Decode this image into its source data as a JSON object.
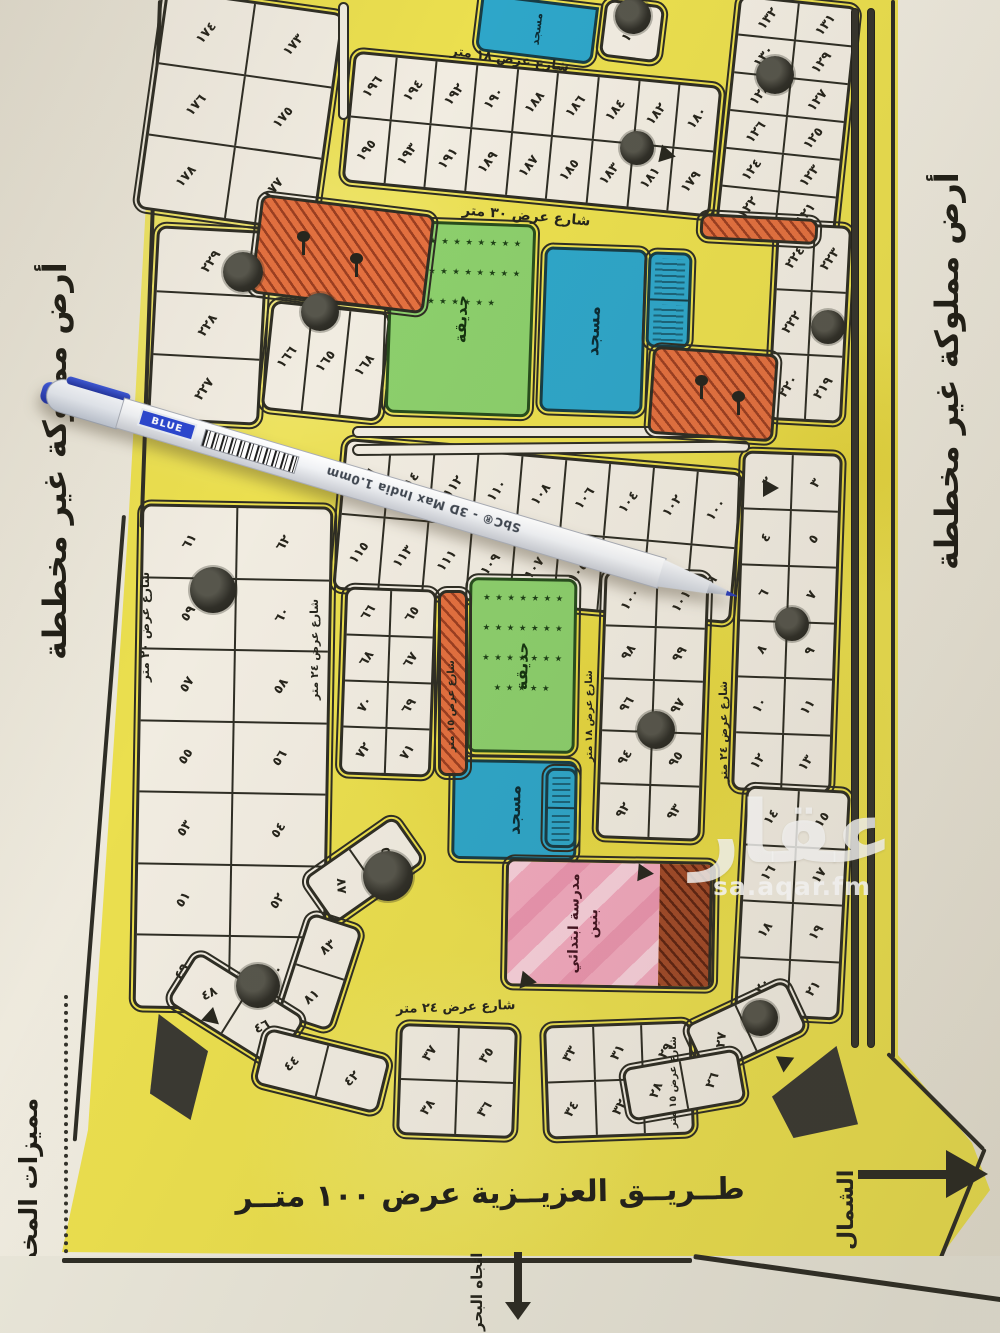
{
  "side_labels": {
    "left": "أرض مملوكة غير مخططة",
    "right": "أرض مملوكة غير مخططة",
    "bottom_left": "مميزات المخطط"
  },
  "compass": {
    "north_label": "الشمال",
    "sea_label": "اتجاه البحر"
  },
  "main_road": {
    "label": "طــريــق العزيــزية عرض ١٠٠ متــر"
  },
  "features": {
    "park_label": "حديقة",
    "mosque_label": "مسجد",
    "school_label": "مدرسة ابتدائي بنين",
    "park_star": "٭"
  },
  "watermark": {
    "logo": "عقار",
    "site": "sa.aqar.fm"
  },
  "pen": {
    "color_label": "BLUE",
    "brand": "SbC® - 3D Max India 1.0mm"
  },
  "colors": {
    "road_yellow": "#ebdf4e",
    "plot_fill": "#f1ece1",
    "ink": "#2e2d24",
    "mosque_blue": "#2ea6c9",
    "park_green": "#8ccf6c",
    "commercial_orange": "#e3703f",
    "school_pink": "#f2a9be",
    "paper": "#e9e4d7"
  },
  "street_labels": [
    {
      "text": "شارع عرض ١٨ متر",
      "x": 450,
      "y": 52,
      "rot": 8,
      "v": false,
      "s": 13
    },
    {
      "text": "شارع عرض ٣٠ متر",
      "x": 462,
      "y": 208,
      "rot": 5,
      "v": false,
      "s": 14
    },
    {
      "text": "شارع عرض ٢٤ متر",
      "x": 396,
      "y": 1000,
      "rot": -2,
      "v": false,
      "s": 13
    },
    {
      "text": "شارع عرض ٢٠ متر",
      "x": 138,
      "y": 682,
      "rot": 0,
      "v": true,
      "s": 12
    },
    {
      "text": "شارع عرض ٢٤ متر",
      "x": 308,
      "y": 700,
      "rot": 0,
      "v": true,
      "s": 11
    },
    {
      "text": "شارع عرض ١٥ متر",
      "x": 446,
      "y": 752,
      "rot": 0,
      "v": true,
      "s": 10
    },
    {
      "text": "شارع عرض ١٨ متر",
      "x": 584,
      "y": 762,
      "rot": 0,
      "v": true,
      "s": 10
    },
    {
      "text": "شارع عرض ٢٤ متر",
      "x": 717,
      "y": 782,
      "rot": 0,
      "v": true,
      "s": 11
    },
    {
      "text": "شارع عرض ١٥ متر",
      "x": 668,
      "y": 1128,
      "rot": 0,
      "v": true,
      "s": 10
    }
  ],
  "blocks": [
    {
      "id": "top-left",
      "x": 150,
      "y": 0,
      "w": 180,
      "h": 222,
      "rot": 8,
      "rows": [
        [
          "١٧٤",
          "١٧٣"
        ],
        [
          "١٧٦",
          "١٧٥"
        ],
        [
          "١٧٨",
          "١٧٧"
        ]
      ]
    },
    {
      "id": "top-row",
      "x": 347,
      "y": 68,
      "w": 370,
      "h": 132,
      "rot": 5.5,
      "rows": [
        [
          "١٩٦",
          "١٩٤",
          "١٩٢",
          "١٩٠",
          "١٨٨",
          "١٨٦",
          "١٨٤",
          "١٨٢",
          "١٨٠"
        ],
        [
          "١٩٥",
          "١٩٣",
          "١٩١",
          "١٨٩",
          "١٨٧",
          "١٨٥",
          "١٨٣",
          "١٨١",
          "١٧٩"
        ]
      ]
    },
    {
      "id": "mosque-corner-cell",
      "x": 602,
      "y": 2,
      "w": 60,
      "h": 58,
      "rot": 7,
      "rows": [
        [
          "١٩٧"
        ]
      ]
    },
    {
      "id": "top-right",
      "x": 727,
      "y": 0,
      "w": 120,
      "h": 232,
      "rot": 6,
      "rows": [
        [
          "١٣٢",
          "١٣١"
        ],
        [
          "١٣٠",
          "١٢٩"
        ],
        [
          "١٢٨",
          "١٢٧"
        ],
        [
          "١٢٦",
          "١٢٥"
        ],
        [
          "١٢٤",
          "١٢٣"
        ],
        [
          "١٢٢",
          "١٢١"
        ]
      ]
    },
    {
      "id": "band2-left-col",
      "x": 152,
      "y": 228,
      "w": 112,
      "h": 195,
      "rot": 3,
      "rows": [
        [
          "٢٢٩"
        ],
        [
          "٢٢٨"
        ],
        [
          "٢٢٧"
        ]
      ]
    },
    {
      "id": "band2-small-row",
      "x": 266,
      "y": 306,
      "w": 120,
      "h": 110,
      "rot": 6,
      "rows": [
        [
          "١٦٦",
          "١٦٥",
          "١٦٨"
        ]
      ]
    },
    {
      "id": "band2-right",
      "x": 772,
      "y": 224,
      "w": 75,
      "h": 198,
      "rot": 3,
      "rows": [
        [
          "٢٢٤",
          "٢٢٣"
        ],
        [
          "٢٢٢",
          "٢٢١"
        ],
        [
          "٢٢٠",
          "٢١٩"
        ]
      ]
    },
    {
      "id": "mid-row",
      "x": 338,
      "y": 455,
      "w": 400,
      "h": 152,
      "rot": 5,
      "rows": [
        [
          "١١٦",
          "١١٤",
          "١١٢",
          "١١٠",
          "١٠٨",
          "١٠٦",
          "١٠٤",
          "١٠٢",
          "١٠٠"
        ],
        [
          "١١٥",
          "١١٣",
          "١١١",
          "١٠٩",
          "١٠٧",
          "١٠٥",
          "١٠٣",
          "١٠١",
          "٩٩"
        ]
      ]
    },
    {
      "id": "right-tall",
      "x": 737,
      "y": 452,
      "w": 100,
      "h": 340,
      "rot": 2,
      "rows": [
        [
          "٢",
          "٣"
        ],
        [
          "٤",
          "٥"
        ],
        [
          "٦",
          "٧"
        ],
        [
          "٨",
          "٩"
        ],
        [
          "١٠",
          "١١"
        ],
        [
          "١٢",
          "١٣"
        ]
      ]
    },
    {
      "id": "left-tall",
      "x": 137,
      "y": 505,
      "w": 192,
      "h": 505,
      "rot": 1,
      "rows": [
        [
          "٦١",
          "٦٢"
        ],
        [
          "٥٩",
          "٦٠"
        ],
        [
          "٥٧",
          "٥٨"
        ],
        [
          "٥٥",
          "٥٦"
        ],
        [
          "٥٣",
          "٥٤"
        ],
        [
          "٥١",
          "٥٢"
        ],
        [
          "٤٩",
          "٥٠"
        ]
      ]
    },
    {
      "id": "inner-small",
      "x": 342,
      "y": 588,
      "w": 92,
      "h": 188,
      "rot": 2,
      "rows": [
        [
          "٦٦",
          "٦٥"
        ],
        [
          "٦٨",
          "٦٧"
        ],
        [
          "٧٠",
          "٦٩"
        ],
        [
          "٧٢",
          "٧١"
        ]
      ]
    },
    {
      "id": "park-right",
      "x": 600,
      "y": 572,
      "w": 105,
      "h": 268,
      "rot": 2,
      "rows": [
        [
          "١٠٠",
          "١٠١"
        ],
        [
          "٩٨",
          "٩٩"
        ],
        [
          "٩٦",
          "٩٧"
        ],
        [
          "٩٤",
          "٩٥"
        ],
        [
          "٩٢",
          "٩٣"
        ]
      ]
    },
    {
      "id": "school-right",
      "x": 740,
      "y": 788,
      "w": 105,
      "h": 230,
      "rot": 3,
      "rows": [
        [
          "١٤",
          "١٥"
        ],
        [
          "١٦",
          "١٧"
        ],
        [
          "١٨",
          "١٩"
        ],
        [
          "٢٠",
          "٢١"
        ]
      ]
    },
    {
      "id": "fan-left-a",
      "x": 308,
      "y": 842,
      "w": 112,
      "h": 56,
      "rot": -35,
      "rows": [
        [
          "٨٧",
          "٨٥"
        ]
      ]
    },
    {
      "id": "fan-left-b",
      "x": 292,
      "y": 918,
      "w": 56,
      "h": 108,
      "rot": 18,
      "rows": [
        [
          "٨٣"
        ],
        [
          "٨١"
        ]
      ]
    },
    {
      "id": "curve-left-a",
      "x": 172,
      "y": 980,
      "w": 128,
      "h": 60,
      "rot": 32,
      "rows": [
        [
          "٤٨",
          "٤٦"
        ]
      ]
    },
    {
      "id": "curve-left-b",
      "x": 258,
      "y": 1042,
      "w": 128,
      "h": 58,
      "rot": 14,
      "rows": [
        [
          "٤٤",
          "٤٢"
        ]
      ]
    },
    {
      "id": "bottom-inner-left",
      "x": 398,
      "y": 1025,
      "w": 118,
      "h": 112,
      "rot": 2,
      "rows": [
        [
          "٣٧",
          "٣٥"
        ],
        [
          "٣٨",
          "٣٦"
        ]
      ]
    },
    {
      "id": "bottom-inner-mid",
      "x": 545,
      "y": 1023,
      "w": 148,
      "h": 114,
      "rot": -2,
      "rows": [
        [
          "٣٣",
          "٣١",
          "٢٩"
        ],
        [
          "٣٤",
          "٣٢",
          "٣٠"
        ]
      ]
    },
    {
      "id": "curve-right-a",
      "x": 690,
      "y": 1000,
      "w": 112,
      "h": 56,
      "rot": -25,
      "rows": [
        [
          "٢٧",
          "٢٥"
        ]
      ]
    },
    {
      "id": "curve-right-b",
      "x": 625,
      "y": 1058,
      "w": 118,
      "h": 54,
      "rot": -10,
      "rows": [
        [
          "٢٨",
          "٢٦"
        ]
      ]
    }
  ],
  "trees": [
    {
      "x": 243,
      "y": 272,
      "r": 20
    },
    {
      "x": 320,
      "y": 312,
      "r": 19
    },
    {
      "x": 637,
      "y": 148,
      "r": 17
    },
    {
      "x": 775,
      "y": 75,
      "r": 19
    },
    {
      "x": 828,
      "y": 327,
      "r": 17
    },
    {
      "x": 633,
      "y": 16,
      "r": 18
    },
    {
      "x": 213,
      "y": 590,
      "r": 23
    },
    {
      "x": 656,
      "y": 730,
      "r": 19
    },
    {
      "x": 792,
      "y": 624,
      "r": 17
    },
    {
      "x": 388,
      "y": 876,
      "r": 25
    },
    {
      "x": 258,
      "y": 986,
      "r": 22
    },
    {
      "x": 760,
      "y": 1018,
      "r": 18
    }
  ],
  "tree_symbols": [
    {
      "x": 302,
      "y": 240
    },
    {
      "x": 355,
      "y": 262
    },
    {
      "x": 700,
      "y": 384
    },
    {
      "x": 737,
      "y": 400
    }
  ],
  "markers": [
    {
      "x": 660,
      "y": 146,
      "rot": 12
    },
    {
      "x": 763,
      "y": 479,
      "rot": 0
    },
    {
      "x": 205,
      "y": 1010,
      "rot": 42
    },
    {
      "x": 779,
      "y": 1052,
      "rot": -25
    },
    {
      "x": 638,
      "y": 864,
      "rot": 5
    },
    {
      "x": 521,
      "y": 972,
      "rot": 10
    }
  ],
  "medians": [
    {
      "x": 352,
      "y": 426,
      "w": 398,
      "h": 12,
      "rot": 0,
      "style": "outline"
    },
    {
      "x": 352,
      "y": 444,
      "w": 398,
      "h": 12,
      "rot": -0.5,
      "style": "outline"
    },
    {
      "x": 338,
      "y": 2,
      "w": 11,
      "h": 118,
      "rot": 0,
      "style": "outline"
    },
    {
      "x": 851,
      "y": 8,
      "w": 8,
      "h": 1040,
      "rot": 0,
      "style": "dark"
    },
    {
      "x": 867,
      "y": 8,
      "w": 8,
      "h": 1040,
      "rot": 0,
      "style": "dark"
    }
  ],
  "islands": [
    {
      "x": 150,
      "y": 1014,
      "w": 58,
      "h": 106,
      "clip": "polygon(15% 0, 100% 35%, 70% 100%, 0 75%)"
    },
    {
      "x": 772,
      "y": 1046,
      "w": 86,
      "h": 92,
      "clip": "polygon(0 55%, 75% 0, 100% 85%, 25% 100%)"
    }
  ]
}
